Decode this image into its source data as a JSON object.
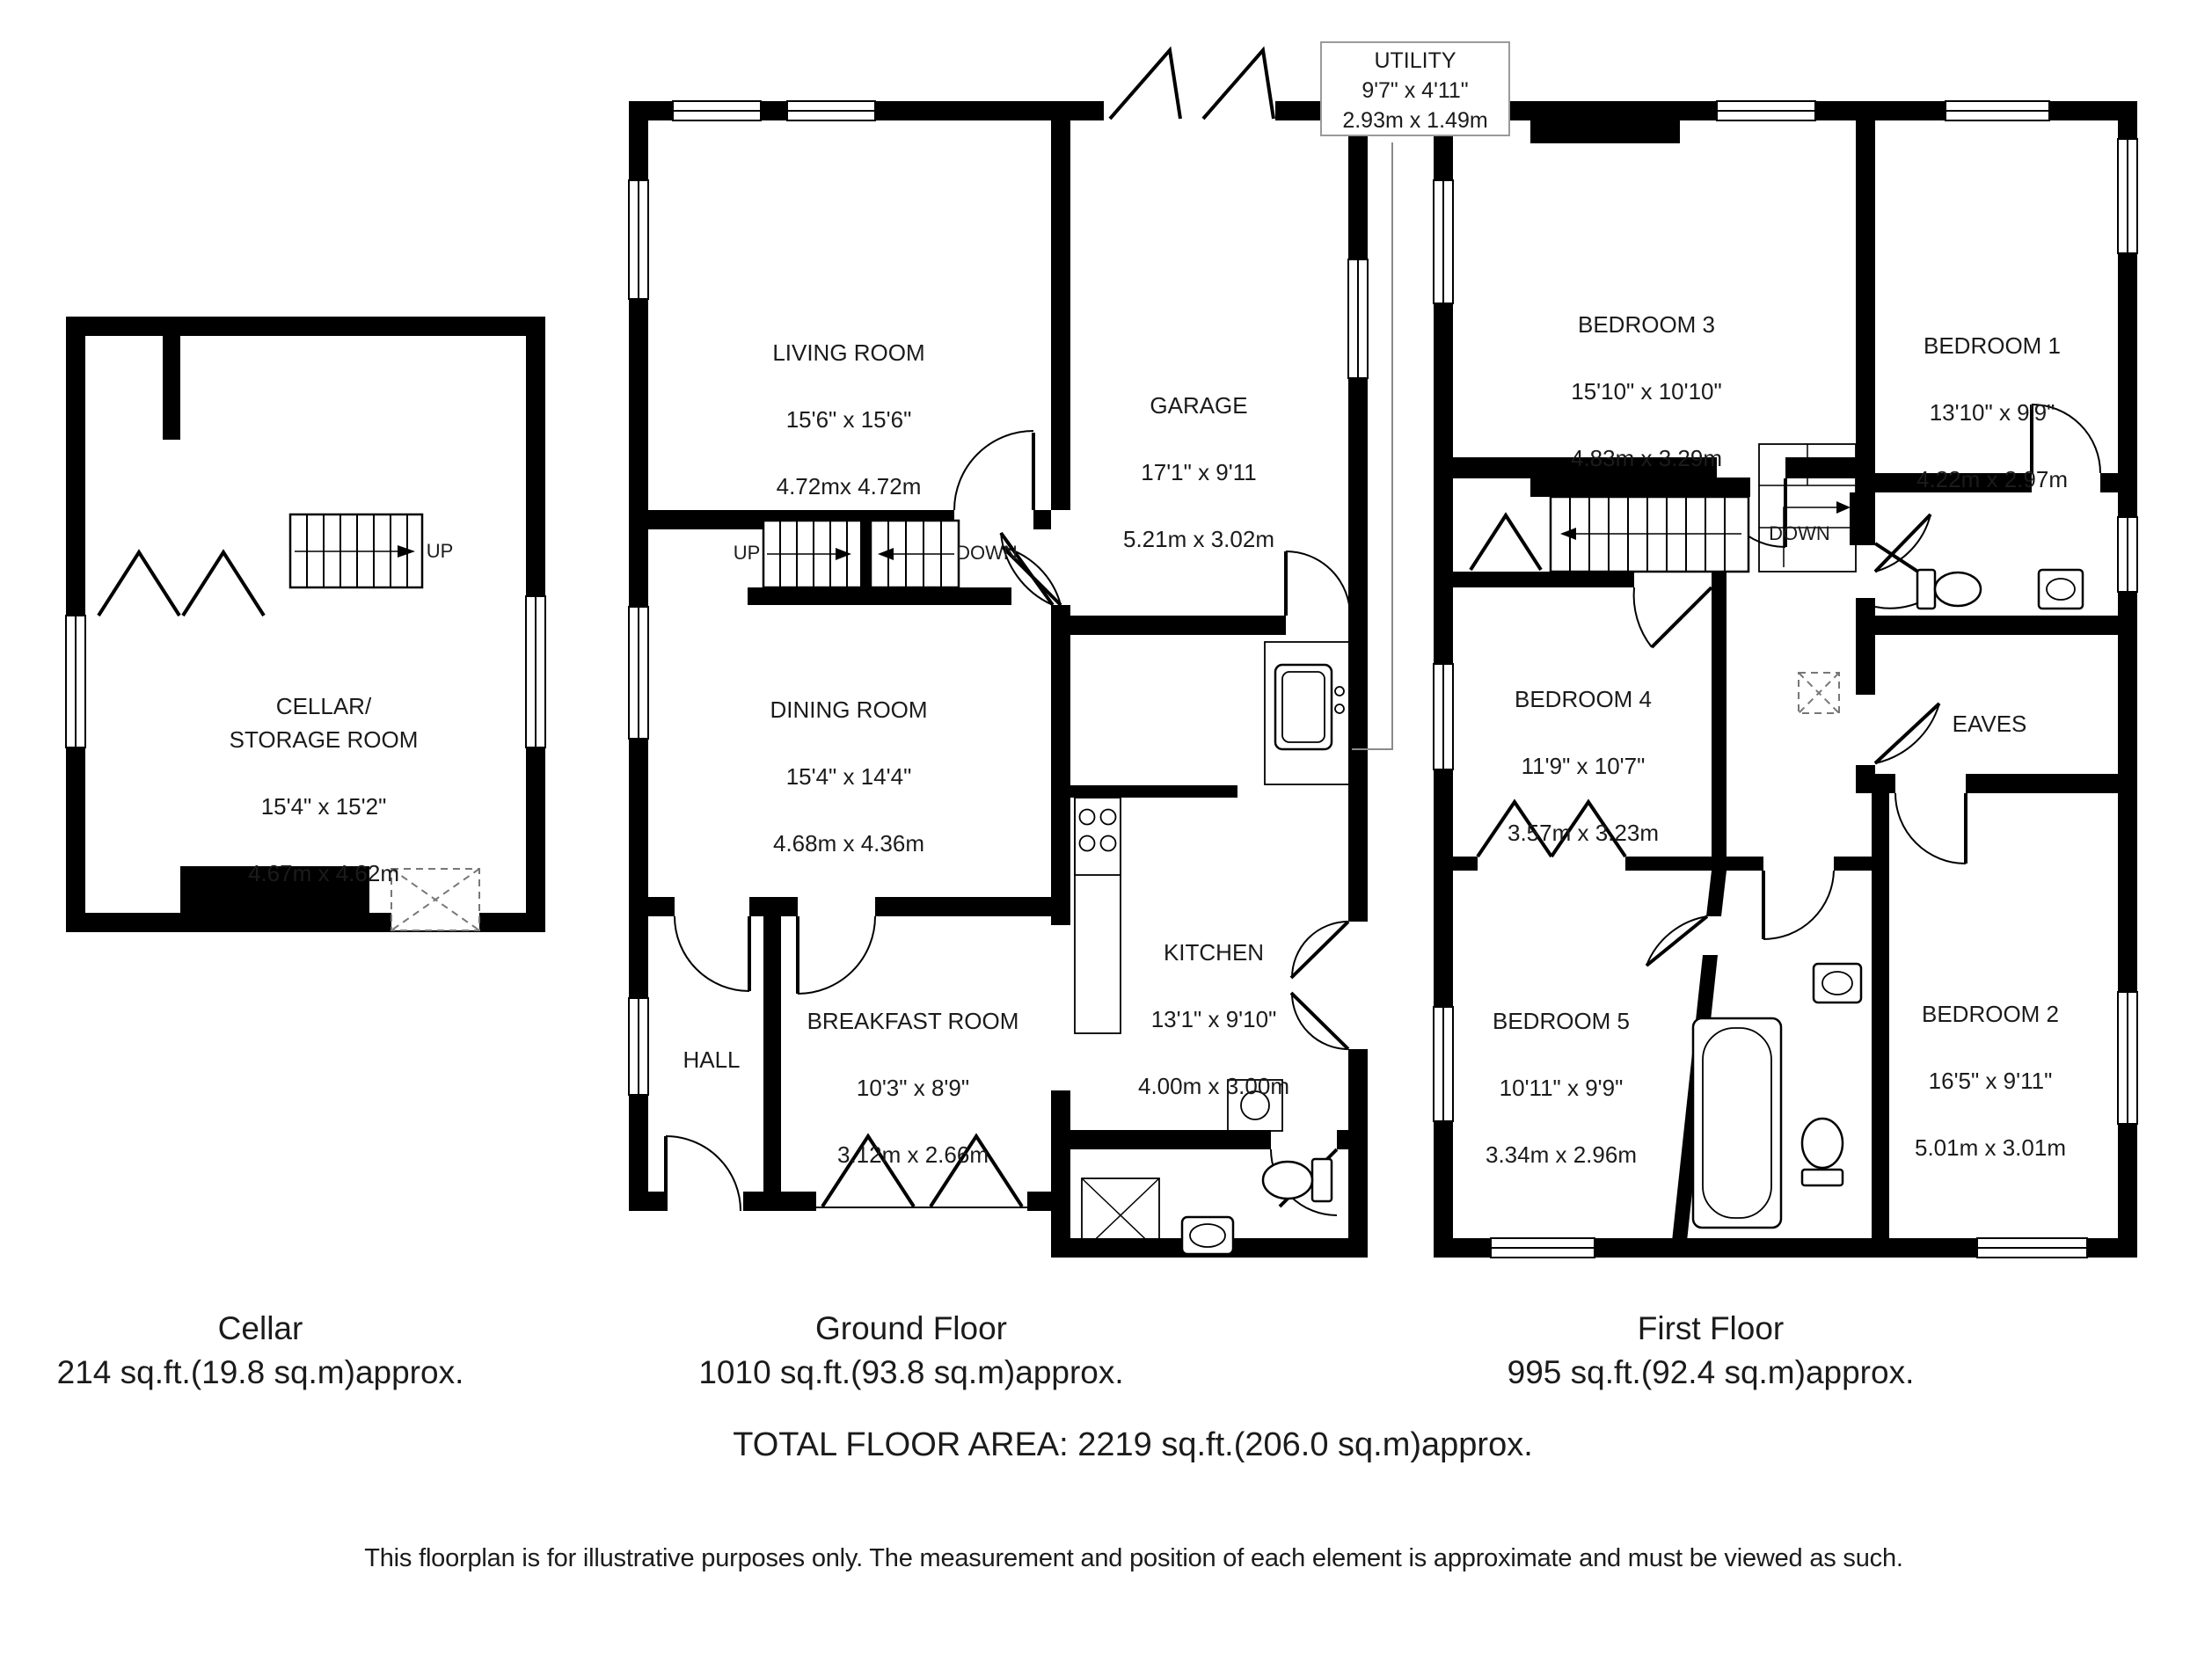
{
  "plans": {
    "cellar": {
      "caption": "Cellar",
      "area": "214 sq.ft.(19.8 sq.m)approx.",
      "rooms": {
        "cellar_storage": {
          "name": "CELLAR/\nSTORAGE ROOM",
          "imperial": "15'4\" x 15'2\"",
          "metric": "4.67m x 4.62m"
        }
      }
    },
    "ground": {
      "caption": "Ground Floor",
      "area": "1010 sq.ft.(93.8 sq.m)approx.",
      "rooms": {
        "living": {
          "name": "LIVING ROOM",
          "imperial": "15'6\" x 15'6\"",
          "metric": "4.72mx 4.72m"
        },
        "garage": {
          "name": "GARAGE",
          "imperial": "17'1\" x 9'11",
          "metric": "5.21m x 3.02m"
        },
        "utility": {
          "name": "UTILITY",
          "imperial": "9'7\" x 4'11\"",
          "metric": "2.93m x 1.49m"
        },
        "dining": {
          "name": "DINING ROOM",
          "imperial": "15'4\" x 14'4\"",
          "metric": "4.68m x 4.36m"
        },
        "kitchen": {
          "name": "KITCHEN",
          "imperial": "13'1\" x 9'10\"",
          "metric": "4.00m x 3.00m"
        },
        "hall": {
          "name": "HALL"
        },
        "breakfast": {
          "name": "BREAKFAST ROOM",
          "imperial": "10'3\" x 8'9\"",
          "metric": "3.12m x 2.66m"
        }
      }
    },
    "first": {
      "caption": "First Floor",
      "area": "995 sq.ft.(92.4 sq.m)approx.",
      "rooms": {
        "bedroom3": {
          "name": "BEDROOM 3",
          "imperial": "15'10\" x 10'10\"",
          "metric": "4.83m x 3.29m"
        },
        "bedroom1": {
          "name": "BEDROOM 1",
          "imperial": "13'10\" x 9'9\"",
          "metric": "4.22m x 2.97m"
        },
        "bedroom4": {
          "name": "BEDROOM 4",
          "imperial": "11'9\" x 10'7\"",
          "metric": "3.57m x 3.23m"
        },
        "eaves": {
          "name": "EAVES"
        },
        "bedroom5": {
          "name": "BEDROOM 5",
          "imperial": "10'11\" x 9'9\"",
          "metric": "3.34m x 2.96m"
        },
        "bedroom2": {
          "name": "BEDROOM 2",
          "imperial": "16'5\" x 9'11\"",
          "metric": "5.01m x 3.01m"
        }
      }
    }
  },
  "stairs": {
    "up": "UP",
    "down": "DOWN"
  },
  "summary": {
    "total": "TOTAL FLOOR AREA: 2219 sq.ft.(206.0 sq.m)approx.",
    "disclaimer": "This floorplan is for illustrative purposes only. The measurement and position of each element is approximate and must be viewed as such."
  },
  "colors": {
    "wall": "#000000",
    "background": "#ffffff",
    "label_box_border": "#9a9a9a",
    "hatch": "#777777"
  }
}
